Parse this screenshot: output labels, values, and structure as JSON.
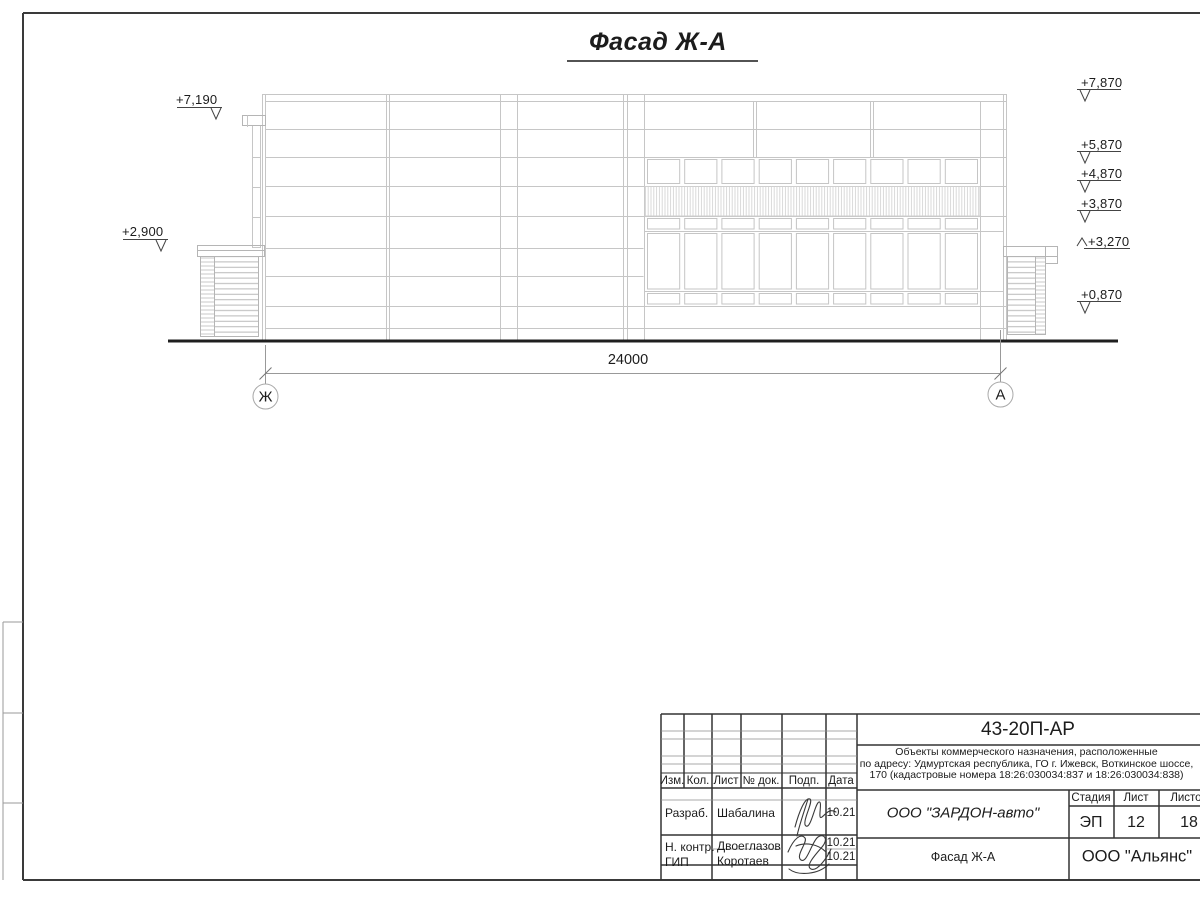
{
  "sheet": {
    "title": "Фасад Ж-А",
    "dimension": "24000",
    "axis_left": "Ж",
    "axis_right": "А",
    "elevation_marks": {
      "left": [
        "+7,190",
        "+2,900"
      ],
      "right": [
        "+7,870",
        "+5,870",
        "+4,870",
        "+3,870",
        "+3,270",
        "+0,870"
      ]
    }
  },
  "title_block": {
    "doc_number": "43-20П-АР",
    "description": [
      "Объекты коммерческого назначения, расположенные",
      "по адресу: Удмуртская республика, ГО г. Ижевск, Воткинское шоссе,",
      "170 (кадастровые номера 18:26:030034:837 и 18:26:030034:838)"
    ],
    "columns": {
      "izm": "Изм.",
      "kol": "Кол.",
      "list": "Лист",
      "doc": "№ док.",
      "podp": "Подп.",
      "data": "Дата"
    },
    "rows": [
      {
        "role": "Разраб.",
        "name": "Шабалина",
        "date": "10.21"
      },
      {
        "role": "Н. контр.",
        "name": "Двоеглазов",
        "date": "10.21"
      },
      {
        "role": "ГИП",
        "name": "Коротаев",
        "date": "10.21"
      }
    ],
    "stage_header": "Стадия",
    "sheet_header": "Лист",
    "sheets_header": "Листов",
    "stage": "ЭП",
    "sheet_no": "12",
    "sheets_total": "18",
    "client": "ООО \"ЗАРДОН-авто\"",
    "drawing_name": "Фасад Ж-А",
    "company": "ООО \"Альянс\""
  },
  "colors": {
    "linework": "#c6c6c6",
    "ink": "#1c1c1c"
  }
}
